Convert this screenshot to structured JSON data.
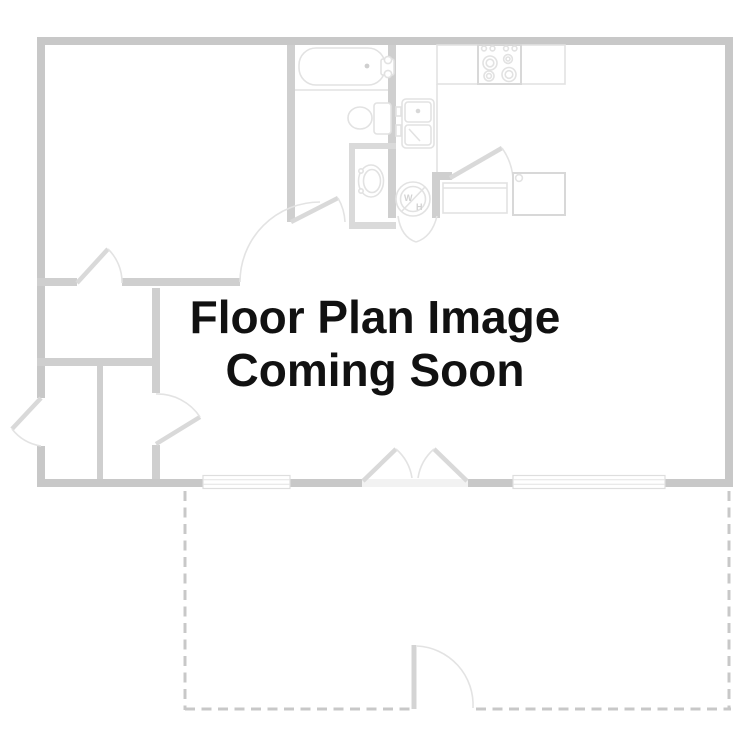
{
  "placeholder": {
    "line1": "Floor Plan Image",
    "line2": "Coming Soon"
  },
  "fixtures": {
    "water_heater_top_label": "W",
    "water_heater_bottom_label": "H"
  },
  "colors": {
    "background": "#ffffff",
    "outer_wall": "#c8c8c8",
    "inner_wall": "#cfcfcf",
    "fixture_outline": "#e2e2e2",
    "door_symbol": "#d9d9d9",
    "patio_dashed": "#c8c8c8",
    "text": "#111111"
  }
}
